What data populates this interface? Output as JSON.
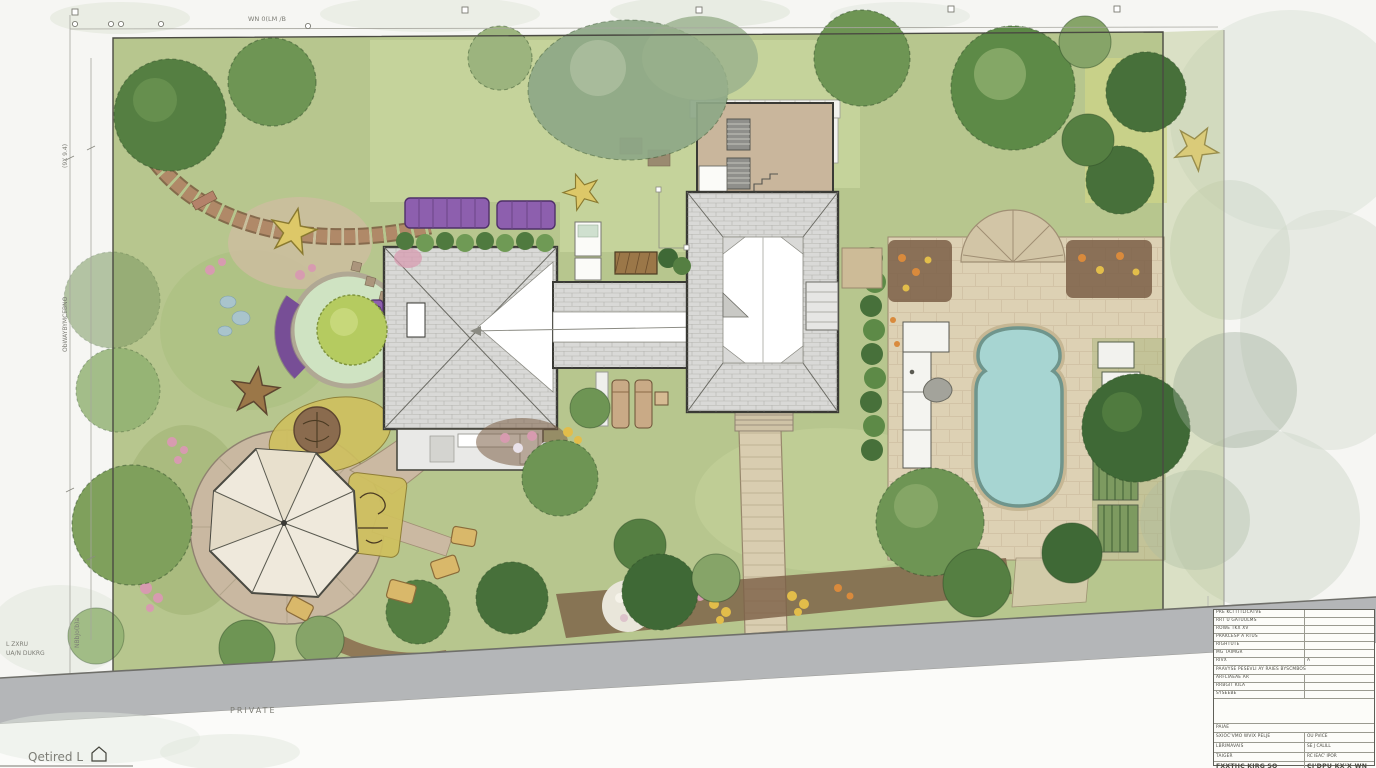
{
  "drawing": {
    "type": "residential landscape architecture site plan",
    "orientation": "plan view (top-down)"
  },
  "colors": {
    "paper": "#f6f6f3",
    "lawn": "#b7c68e",
    "lawn_light": "#c6d49c",
    "circle_lawn": "#cfe3c2",
    "roof": "#d9d9d7",
    "roof_outline": "#3a3a35",
    "deck": "#ddd1b4",
    "pool_water": "#a7d5d2",
    "pool_rim": "#6f958c",
    "road": "#b4b6b8",
    "path": "#d9cdb0",
    "plaza": "#c9b8a1",
    "canopy": "#efe9dc",
    "purple_furniture": "#8d5fae",
    "activity_yellow": "#cfc05e",
    "mulch": "#7b5f46",
    "tree_dark": "#3f6936",
    "tree_mid": "#6e9554",
    "tree_light": "#9cb47e",
    "brick": "#b08968",
    "flower_pink": "#d79bb0",
    "flower_yellow": "#e2bd4a",
    "flower_orange": "#d98a3c",
    "pond_stone": "#a9c4cc"
  },
  "annotations": {
    "top_label": "WN 0(LM /B",
    "dim_left_upper": "(9X 9.4)",
    "dim_left_middle": "ObWAYBYMCEBNO",
    "dim_left_lower": "NBbJo(b)a",
    "note_line1": "L ZXRU",
    "note_line2": "UA/N DUKRG",
    "road_label": "PRIVATE",
    "bottom_left_label": "Qetired L"
  },
  "titleblock": {
    "rows": [
      {
        "label": "PRE KCI ITTLICATVE",
        "value": ""
      },
      {
        "label": "RRT U GATUULMS",
        "value": ""
      },
      {
        "label": "ROWE TKX XV",
        "value": ""
      },
      {
        "label": "PRAKCESP A RTUS",
        "value": ""
      },
      {
        "label": "RIGHTUTE",
        "value": ""
      },
      {
        "label": "MG TAIMGR",
        "value": ""
      },
      {
        "label": "RIVX",
        "value": "A"
      },
      {
        "label": "PAAVYSE PESEVLI AY RAIES BYSCMBOS",
        "value": ""
      },
      {
        "label": "ARFLIAEAE AR",
        "value": ""
      },
      {
        "label": "RRBGIT KILA",
        "value": ""
      },
      {
        "label": "SYSEEBE",
        "value": ""
      },
      {
        "label": "",
        "value": ""
      },
      {
        "label": "PAIAE",
        "value": ""
      },
      {
        "label": "SXIOC'VMO WVIX PELJE",
        "value": "OU   PVICE"
      },
      {
        "label": "LBRIMAVAIS",
        "value": "SE   J CALILL"
      },
      {
        "label": "TAIGER",
        "value": "RC IEAC' IPOR"
      },
      {
        "label": "FXXTHC KIRG   SQ",
        "value": "CI'DPU KX'X WN"
      },
      {
        "label": "ETIEX",
        "value": "FEB J K)"
      }
    ]
  }
}
